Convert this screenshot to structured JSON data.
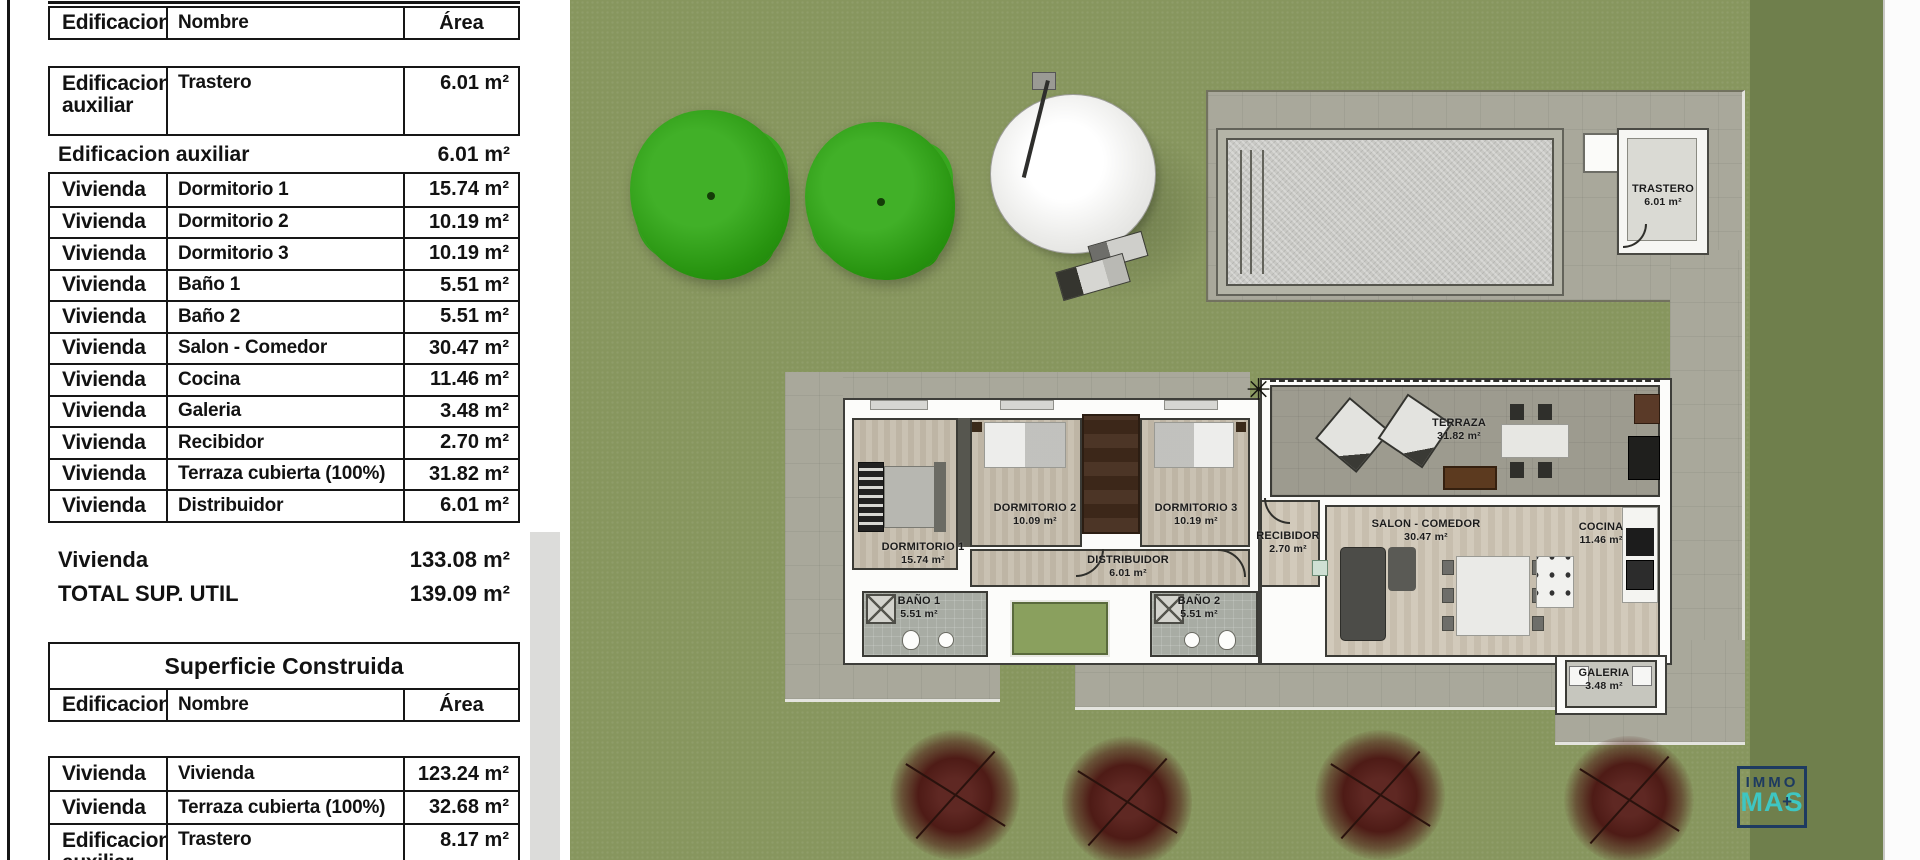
{
  "left_panel": {
    "columns": [
      "Edificacion",
      "Nombre",
      "Área"
    ],
    "superficie_util": {
      "aux_row": {
        "edificacion": "Edificacion auxiliar",
        "nombre": "Trastero",
        "area": "6.01 m²"
      },
      "aux_subtotal": {
        "label": "Edificacion auxiliar",
        "value": "6.01 m²"
      },
      "rows": [
        {
          "edificacion": "Vivienda",
          "nombre": "Dormitorio 1",
          "area": "15.74 m²"
        },
        {
          "edificacion": "Vivienda",
          "nombre": "Dormitorio 2",
          "area": "10.19 m²"
        },
        {
          "edificacion": "Vivienda",
          "nombre": "Dormitorio 3",
          "area": "10.19 m²"
        },
        {
          "edificacion": "Vivienda",
          "nombre": "Baño 1",
          "area": "5.51 m²"
        },
        {
          "edificacion": "Vivienda",
          "nombre": "Baño 2",
          "area": "5.51 m²"
        },
        {
          "edificacion": "Vivienda",
          "nombre": "Salon - Comedor",
          "area": "30.47 m²"
        },
        {
          "edificacion": "Vivienda",
          "nombre": "Cocina",
          "area": "11.46 m²"
        },
        {
          "edificacion": "Vivienda",
          "nombre": "Galeria",
          "area": "3.48 m²"
        },
        {
          "edificacion": "Vivienda",
          "nombre": "Recibidor",
          "area": "2.70 m²"
        },
        {
          "edificacion": "Vivienda",
          "nombre": "Terraza cubierta (100%)",
          "area": "31.82 m²"
        },
        {
          "edificacion": "Vivienda",
          "nombre": "Distribuidor",
          "area": "6.01 m²"
        }
      ],
      "vivienda_subtotal": {
        "label": "Vivienda",
        "value": "133.08 m²"
      },
      "total": {
        "label": "TOTAL SUP. UTIL",
        "value": "139.09 m²"
      }
    },
    "superficie_construida": {
      "title": "Superficie Construida",
      "rows": [
        {
          "edificacion": "Vivienda",
          "nombre": "Vivienda",
          "area": "123.24 m²"
        },
        {
          "edificacion": "Vivienda",
          "nombre": "Terraza cubierta (100%)",
          "area": "32.68 m²"
        },
        {
          "edificacion": "Edificacion auxiliar",
          "nombre": "Trastero",
          "area": "8.17 m²"
        }
      ]
    }
  },
  "plan": {
    "rooms": [
      {
        "name": "TRASTERO",
        "area": "6.01 m²"
      },
      {
        "name": "TERRAZA",
        "area": "31.82 m²"
      },
      {
        "name": "DORMITORIO 1",
        "area": "15.74 m²"
      },
      {
        "name": "DORMITORIO 2",
        "area": "10.09 m²"
      },
      {
        "name": "DORMITORIO 3",
        "area": "10.19 m²"
      },
      {
        "name": "DISTRIBUIDOR",
        "area": "6.01 m²"
      },
      {
        "name": "RECIBIDOR",
        "area": "2.70 m²"
      },
      {
        "name": "BAÑO 1",
        "area": "5.51 m²"
      },
      {
        "name": "BAÑO 2",
        "area": "5.51 m²"
      },
      {
        "name": "SALON - COMEDOR",
        "area": "30.47 m²"
      },
      {
        "name": "COCINA",
        "area": "11.46 m²"
      },
      {
        "name": "GALERIA",
        "area": "3.48 m²"
      }
    ],
    "icons": {
      "plant": "✳"
    },
    "logo": {
      "line1": "IMMO",
      "line2": "MAS",
      "plus": "+"
    }
  },
  "colors": {
    "grass": "#87965E",
    "grass_dark": "#6F7F4C",
    "paving": "#A9A89B",
    "logo_navy": "#1D3A60",
    "logo_teal": "#3EC6C2"
  }
}
